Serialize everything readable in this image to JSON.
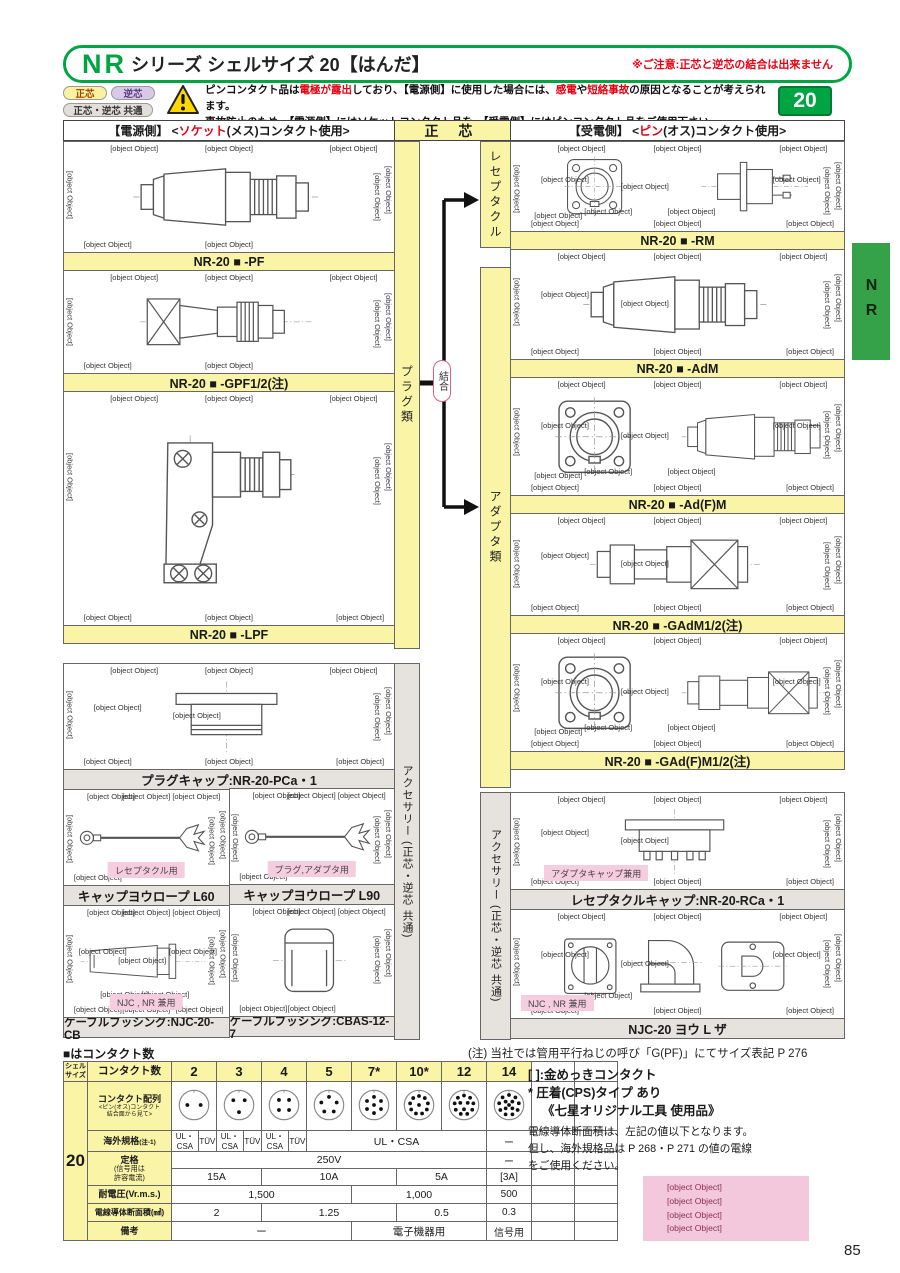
{
  "page": {
    "title_series": "NR",
    "title_rest": "シリーズ シェルサイズ 20【はんだ】",
    "title_caution": "※ご注意:正芯と逆芯の結合は出来ません",
    "shell_size_badge": "20",
    "side_tab": "NR",
    "page_number": "85"
  },
  "legend": {
    "badge_normal": "正芯",
    "badge_reverse": "逆芯",
    "badge_common": "正芯・逆芯 共通",
    "warning": {
      "l1_a": "ピンコンタクト品は",
      "l1_red1": "電極が露出",
      "l1_b": "しており、【電源側】に使用した場合には、",
      "l1_red2": "感電",
      "l1_c": "や",
      "l1_red3": "短絡事故",
      "l1_d": "の原因となることが考えられます。",
      "l2": "事故防止のため、【電源側】にはソケットコンタクト品を、【受電側】にはピンコンタクト品をご使用下さい。"
    }
  },
  "columns": {
    "left_header": {
      "pre": "【電源側】 <",
      "red": "ソケット",
      "post": "(メス)コンタクト使用>"
    },
    "center_header": "正 芯",
    "right_header": {
      "pre": "【受電側】 <",
      "red": "ピン",
      "post": "(オス)コンタクト使用>"
    },
    "strip_plug": "プラグ類",
    "strip_receptacle": "レセプタクル",
    "strip_adapter": "アダプタ類",
    "strip_accessory": "アクセサリー (正芯・逆芯 共通)",
    "join_label": "結合"
  },
  "products_left": [
    {
      "label": "NR-20 ■ -PF",
      "shape": "#sym-plug",
      "dims": [
        "A",
        "",
        "",
        "φ27",
        "φ16.3",
        "",
        "A:ケーブル締付範囲 φ10~φ12.5",
        "50"
      ]
    },
    {
      "label": "NR-20 ■ -GPF1/2(注)",
      "shape": "#sym-gplug",
      "dims": [
        "G1/2",
        "",
        "",
        "φ27",
        "φ16.3",
        "φ29.5",
        "",
        "58.5"
      ]
    },
    {
      "label": "NR-20 ■ -LPF",
      "shape": "#sym-elbow",
      "dims": [
        "",
        "48.5",
        "",
        "φ27",
        "φ16.3",
        "51.5",
        "",
        "A",
        "A:ケーブル締付範囲 φ10~φ12.5"
      ]
    }
  ],
  "products_right": [
    {
      "label": "NR-20 ■ -RM",
      "shape": "#sym-flange",
      "shape2": "#sym-rside",
      "dims": [
        "4-3.4穴",
        "",
        "",
        "φ20",
        "29",
        "",
        "23",
        "25.9~29.8",
        "A:2.3",
        "φ16.6",
        "",
        "23",
        "10.5",
        "9.7",
        "29"
      ]
    },
    {
      "label": "NR-20 ■ -AdM",
      "shape": "#sym-plug",
      "dims": [
        "",
        "",
        "",
        "A",
        "",
        "φ25",
        "",
        "48.5",
        "A:ケーブル締付範囲 φ10~φ12.5",
        "",
        "φ16.6"
      ]
    },
    {
      "label": "NR-20 ■ -Ad(F)M",
      "shape": "#sym-flange",
      "shape2": "#sym-plug",
      "dims": [
        "4-3.4穴",
        "",
        "A:ケーブル締付範囲 φ10~φ12.5",
        "A",
        "29",
        "",
        "23",
        "48.5",
        "",
        "23",
        "φ16.6",
        "φ22.8",
        "10.5",
        "2.3",
        "29"
      ]
    },
    {
      "label": "NR-20 ■ -GAdM1/2(注)",
      "shape": "#sym-gadapt",
      "dims": [
        "",
        "",
        "G1/2",
        "φ29.5",
        "",
        "φ25",
        "",
        "57",
        "",
        "",
        "φ16.6"
      ]
    },
    {
      "label": "NR-20 ■ -GAd(F)M1/2(注)",
      "shape": "#sym-flange",
      "shape2": "#sym-gadapt",
      "dims": [
        "4-3.4穴",
        "φ22.8",
        "G1/2",
        "φ29.5",
        "29",
        "",
        "23",
        "57",
        "",
        "23",
        "φ16.6",
        "",
        "10.5",
        "2.3",
        "29"
      ]
    }
  ],
  "accessories_left": {
    "cap": {
      "label": "プラグキャップ:NR-20-PCa・1",
      "shape": "#sym-cap",
      "dims": [
        "",
        "29",
        "",
        "",
        "",
        "12.5",
        "",
        "φ26",
        "",
        "φ20.4",
        "10.5"
      ]
    },
    "rope60": {
      "label": "キャップヨウロープ L60",
      "badge": "レセプタクル用",
      "shape": "#sym-rope",
      "dims": [
        "",
        "約60",
        "",
        "",
        "",
        "",
        "3.2穴"
      ]
    },
    "rope90": {
      "label": "キャップヨウロープ L90",
      "badge": "プラグ,アダプタ用",
      "shape": "#sym-rope",
      "dims": [
        "",
        "約90",
        "",
        "",
        "",
        "",
        "3.2穴"
      ]
    },
    "bushing1": {
      "label": "ケーブルブッシング:NJC-20-CB",
      "badge": "NJC , NR 兼用",
      "shape": "#sym-bushing",
      "dims": [
        "4",
        "",
        "",
        "φ15",
        "φ10",
        "φ10",
        "",
        "30",
        "2",
        "",
        "φ7.5",
        "",
        "",
        "9"
      ]
    },
    "bushing2": {
      "label": "ケーブルブッシング:CBAS-12-7",
      "shape": "#sym-block",
      "dims": [
        "",
        "",
        "",
        "φ12",
        "φ7",
        "",
        "",
        "10"
      ]
    }
  },
  "accessories_right": {
    "rcap": {
      "label": "レセプタクルキャップ:NR-20-RCa・1",
      "badge": "アダプタキャップ兼用",
      "shape": "#sym-rcap",
      "dims": [
        "",
        "32",
        "",
        "",
        "",
        "12.5",
        "",
        "φ28.5",
        "",
        "φ24",
        "10.5"
      ]
    },
    "lbracket": {
      "label": "NJC-20 ヨウ L ザ",
      "badge": "NJC , NR 兼用",
      "shape": "#sym-lbr",
      "dims": [
        "4-M3タップ",
        "32",
        "2-3.4穴",
        "29",
        "23",
        "35.3",
        "5.3",
        "A矢視",
        "38.4",
        "",
        "5",
        "32.8",
        "23"
      ]
    }
  },
  "contact_table": {
    "shell_header_1": "シェル",
    "shell_header_2": "サイズ",
    "shell_size": "20",
    "count_label": "コンタクト数",
    "counts": [
      "2",
      "3",
      "4",
      "5",
      "7*",
      "10*",
      "12",
      "14"
    ],
    "pin_counts": [
      2,
      3,
      4,
      5,
      7,
      10,
      12,
      14
    ],
    "arrangement": {
      "label": "コンタクト配列",
      "sub1": "<ピン(オス)コンタクト",
      "sub2": "結合面から見て>"
    },
    "foreign": {
      "label": "海外規格",
      "label_note": "(注-1)",
      "pairs": [
        [
          "UL・CSA",
          "TÜV"
        ],
        [
          "UL・CSA",
          "TÜV"
        ],
        [
          "UL・CSA",
          "TÜV"
        ]
      ],
      "span": "UL・CSA",
      "c14": "ー"
    },
    "rating": {
      "label_1": "定格",
      "label_2": "(信号用は",
      "label_3": "許容電流)",
      "voltage": "250V",
      "voltage_c14": "ー",
      "currents": [
        "15A",
        "10A",
        "5A",
        "[3A]"
      ]
    },
    "withstand": {
      "label": "耐電圧(Vr.m.s.)",
      "values": [
        "1,500",
        "1,000",
        "500"
      ]
    },
    "wire": {
      "label": "電線導体断面積(㎟)",
      "values": [
        "2",
        "1.25",
        "0.5",
        "0.3"
      ]
    },
    "remarks": {
      "label": "備考",
      "values": [
        "ー",
        "電子機器用",
        "信号用"
      ]
    }
  },
  "notes": {
    "table_caption": "■はコンタクト数",
    "g_note": "(注) 当社では管用平行ねじの呼び「G(PF)」にてサイズ表記 P 276",
    "gold_note": "[ ]:金めっきコンタクト",
    "crimp_note": "* 圧着(CPS)タイプ あり",
    "tool_note": "《七星オリジナル工具 使用品》",
    "wire_note_1": "電線導体断面積は、左記の値以下となります。",
    "wire_note_2": "但し、海外規格品は P 268・P 271 の値の電線",
    "wire_note_3": "をご使用ください。",
    "pink_note": [
      "注 -1 別途指定",
      "「UL と CSA のセット指定」又は",
      "「TÜV 指定」の選択となります。",
      "海外規格については P 268・P 271"
    ]
  }
}
